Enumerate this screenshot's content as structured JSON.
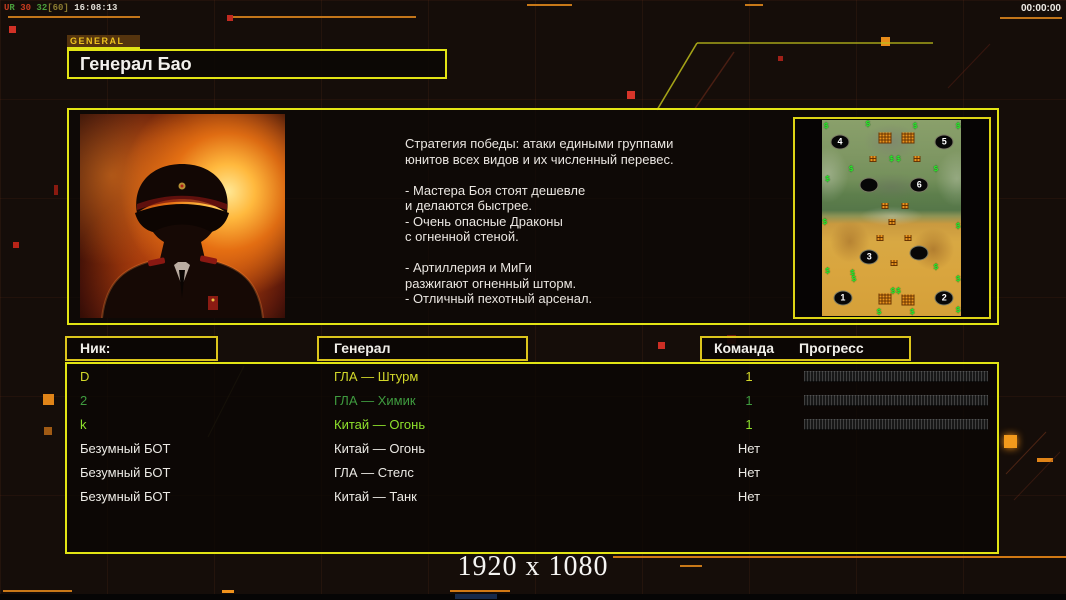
{
  "overlay": {
    "stats_parts": [
      {
        "text": "U",
        "color": "#c83c20"
      },
      {
        "text": "R",
        "color": "#4a9e3c"
      },
      {
        "text": " 30 ",
        "color": "#c83c20"
      },
      {
        "text": "32",
        "color": "#4a9e3c"
      },
      {
        "text": "[60]",
        "color": "#8a7a30"
      },
      {
        "text": " 16:08:13",
        "color": "#e0ddd6"
      }
    ],
    "clock": "00:00:00"
  },
  "header": {
    "tab_label": "GENERAL",
    "title": "Генерал Бао"
  },
  "info_panel": {
    "strategy_lines": [
      "Стратегия победы: атаки едиными группами",
      "юнитов всех видов и их численный перевес.",
      "",
      "- Мастера Боя стоят дешевле",
      "и делаются быстрее.",
      "- Очень опасные Драконы",
      "с огненной стеной.",
      "",
      "- Артиллерия и МиГи",
      "разжигают огненный шторм.",
      "- Отличный пехотный арсенал."
    ]
  },
  "minimap": {
    "start_positions": [
      {
        "label": "4",
        "x": 13,
        "y": 11
      },
      {
        "label": "5",
        "x": 88,
        "y": 11
      },
      {
        "label": "",
        "x": 34,
        "y": 33
      },
      {
        "label": "6",
        "x": 70,
        "y": 33
      },
      {
        "label": "3",
        "x": 34,
        "y": 70
      },
      {
        "label": "",
        "x": 70,
        "y": 68
      },
      {
        "label": "1",
        "x": 15,
        "y": 91
      },
      {
        "label": "2",
        "x": 88,
        "y": 91
      }
    ],
    "supply_piles_large": [
      {
        "x": 45,
        "y": 9
      },
      {
        "x": 62,
        "y": 9
      },
      {
        "x": 45.5,
        "y": 91.5
      },
      {
        "x": 62,
        "y": 92
      }
    ],
    "supply_piles_small": [
      {
        "x": 37,
        "y": 20
      },
      {
        "x": 68,
        "y": 20
      },
      {
        "x": 45,
        "y": 44
      },
      {
        "x": 60,
        "y": 44
      },
      {
        "x": 50,
        "y": 52
      },
      {
        "x": 42,
        "y": 60
      },
      {
        "x": 62,
        "y": 60
      },
      {
        "x": 52,
        "y": 73
      }
    ],
    "money_symbol": "$",
    "money_marks": [
      {
        "x": 3,
        "y": 3
      },
      {
        "x": 33,
        "y": 2
      },
      {
        "x": 67,
        "y": 3
      },
      {
        "x": 98,
        "y": 3
      },
      {
        "x": 50,
        "y": 20
      },
      {
        "x": 55,
        "y": 20
      },
      {
        "x": 21,
        "y": 25
      },
      {
        "x": 4,
        "y": 30
      },
      {
        "x": 82,
        "y": 25
      },
      {
        "x": 2,
        "y": 52
      },
      {
        "x": 98,
        "y": 54
      },
      {
        "x": 4,
        "y": 77
      },
      {
        "x": 22,
        "y": 78
      },
      {
        "x": 23,
        "y": 81
      },
      {
        "x": 82,
        "y": 75
      },
      {
        "x": 98,
        "y": 81
      },
      {
        "x": 51,
        "y": 87
      },
      {
        "x": 55,
        "y": 87
      },
      {
        "x": 41,
        "y": 98
      },
      {
        "x": 65,
        "y": 98
      },
      {
        "x": 98,
        "y": 97
      }
    ]
  },
  "table": {
    "headers": {
      "nick": "Ник:",
      "general": "Генерал",
      "team": "Команда",
      "progress": "Прогресс"
    },
    "rows": [
      {
        "nick": "D",
        "general": "ГЛА — Штурм",
        "team": "1",
        "color": "#d2d82a",
        "progress": true
      },
      {
        "nick": "2",
        "general": "ГЛА — Химик",
        "team": "1",
        "color": "#3f9b3f",
        "progress": true
      },
      {
        "nick": "k",
        "general": "Китай — Огонь",
        "team": "1",
        "color": "#8ee02c",
        "progress": true
      },
      {
        "nick": "Безумный БОТ",
        "general": "Китай — Огонь",
        "team": "Нет",
        "color": "#eceae5",
        "progress": false
      },
      {
        "nick": "Безумный БОТ",
        "general": "ГЛА — Стелс",
        "team": "Нет",
        "color": "#eceae5",
        "progress": false
      },
      {
        "nick": "Безумный БОТ",
        "general": "Китай — Танк",
        "team": "Нет",
        "color": "#eceae5",
        "progress": false
      }
    ]
  },
  "footer": {
    "resolution": "1920 x 1080"
  }
}
